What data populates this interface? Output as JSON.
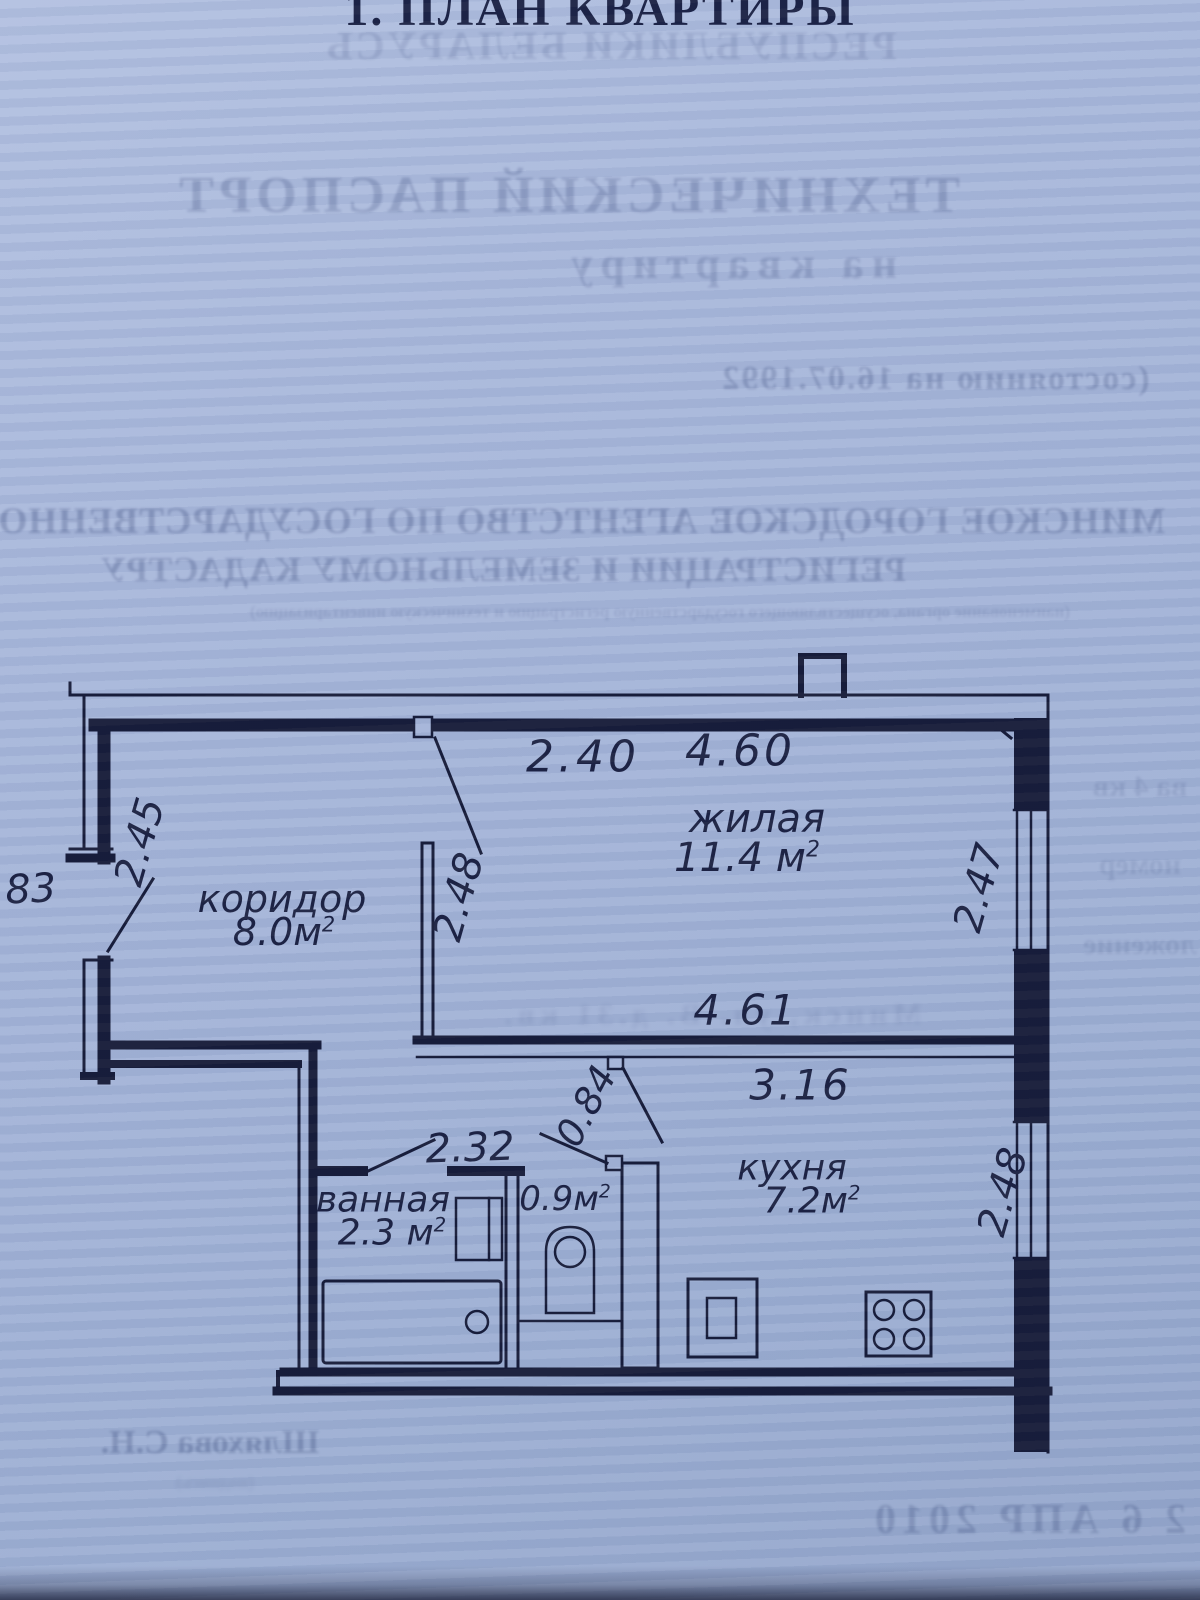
{
  "header": {
    "title": "1. ПЛАН КВАРТИРЫ",
    "bleed_country": "РЕСПУБЛИКИ БЕЛАРУСЬ",
    "bleed_doc_title": "ТЕХНИЧЕСКИЙ ПАСПОРТ",
    "bleed_doc_subtitle": "на квартиру",
    "bleed_date_line": "(состоянию на 16.07.1992",
    "bleed_agency_line1": "МИНСКОЕ ГОРОДСКОЕ АГЕНТСТВО ПО ГОСУДАРСТВЕННОЙ",
    "bleed_agency_line2": "РЕГИСТРАЦИИ И ЗЕМЕЛЬНОМУ КАДАСТРУ",
    "bleed_agency_note": "(наименование органа, осуществляющего государственную регистрацию и техническую инвентаризацию)"
  },
  "plan": {
    "rooms": {
      "corridor": {
        "name": "коридор",
        "area": "8.0м",
        "sup": "2"
      },
      "living": {
        "name": "жилая",
        "area": "11.4 м",
        "sup": "2"
      },
      "bath": {
        "name": "ванная",
        "area": "2.3 м",
        "sup": "2"
      },
      "wc": {
        "area": "0.9м",
        "sup": "2"
      },
      "kitchen": {
        "name": "кухня",
        "area": "7.2м",
        "sup": "2"
      }
    },
    "dims": {
      "top_left": "2.40",
      "top_right": "4.60",
      "left": "2.45",
      "entry_door": "183",
      "partition": "2.48",
      "living_right": "2.47",
      "mid": "4.61",
      "kitchen_width": "3.16",
      "kitchen_door": "0.84",
      "bath_width": "2.32",
      "kitchen_right": "2.48"
    }
  },
  "bleed_fragments": {
    "right1": "ва 4 кв",
    "right2": "номер",
    "right3": "ложение",
    "mid": "Минск, ул. В.  д.31 кв."
  },
  "footer": {
    "signature": "Шляхова С.Н.",
    "signature_note": "(подпись)",
    "stamp_date": "2 6 АПР 2010"
  },
  "colors": {
    "paper": "#a4b4d8",
    "ink": "#161b38",
    "bleed_ink": "#2c3c6e"
  }
}
